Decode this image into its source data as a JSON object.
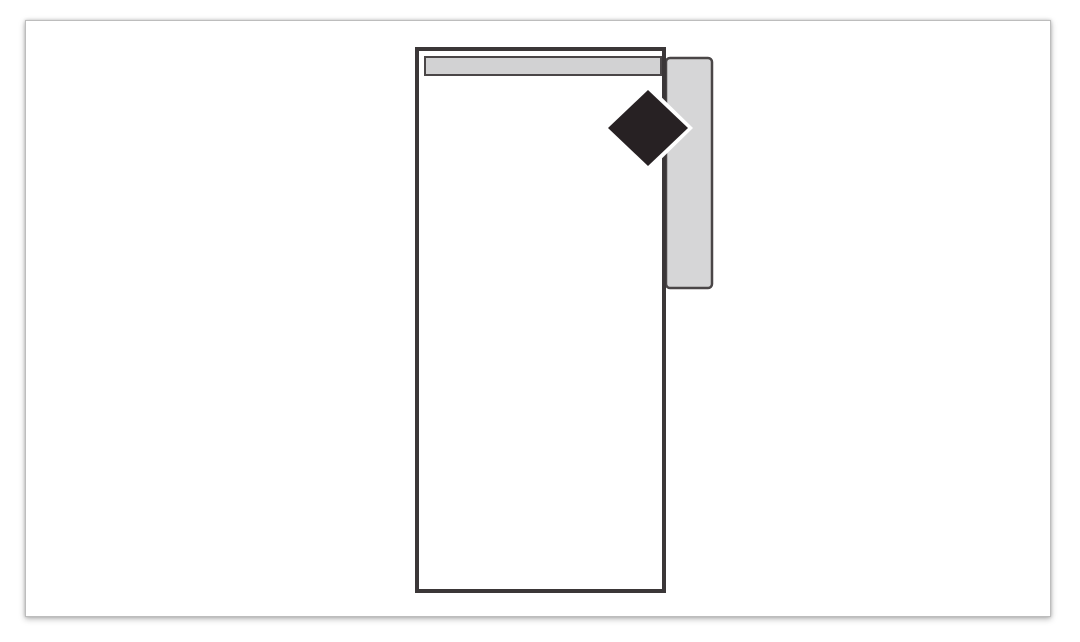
{
  "page": {
    "background": "#ffffff",
    "panel": {
      "background": "#ffffff",
      "border_color": "#bdbdbd"
    }
  },
  "figure": {
    "name": "chaise-unit-top-view-symbol",
    "shapes": {
      "right_arm": {
        "fill": "#d6d6d7",
        "stroke": "#4a4647"
      },
      "body": {
        "fill": "#ffffff",
        "stroke": "#3b3738"
      },
      "backrest_bar": {
        "fill": "#d2d2d3",
        "stroke": "#4a4647"
      },
      "diamond_marker": {
        "fill": "#272123",
        "halo": "#ffffff"
      }
    }
  }
}
